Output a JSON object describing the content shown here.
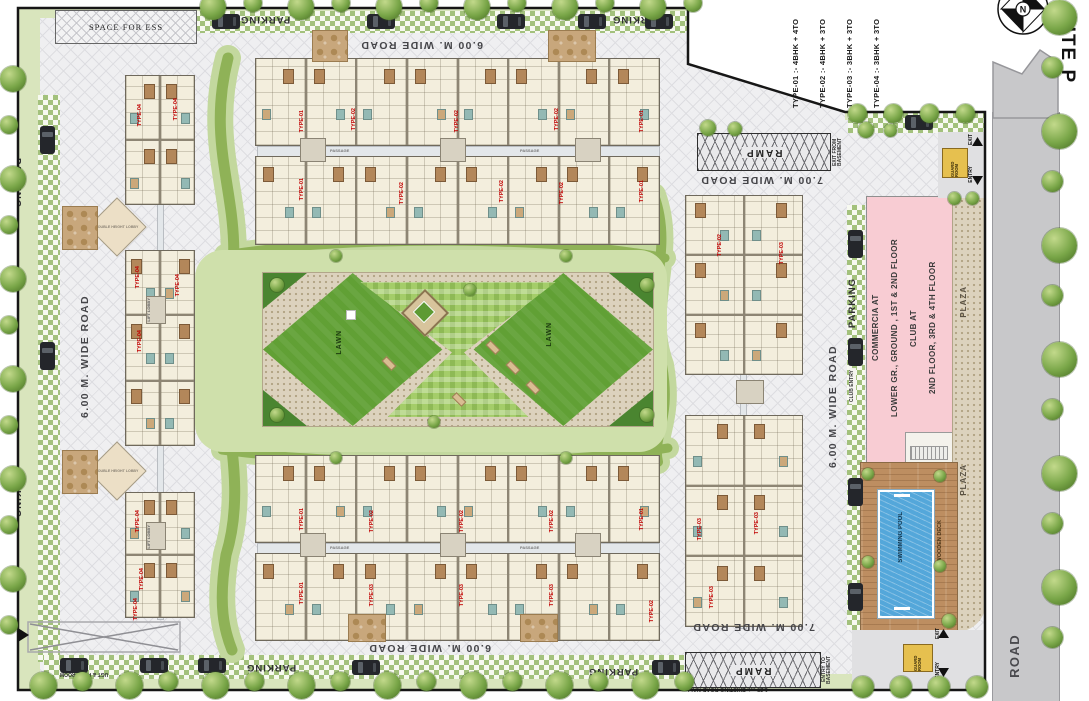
{
  "title": {
    "text": "SITE P",
    "north": "N"
  },
  "legend": {
    "items": [
      "TYPE-01 :- 4BHK + 4TO",
      "TYPE-02 :- 4BHK + 3TO",
      "TYPE-03 :- 3BHK + 3TO",
      "TYPE-04 :- 3BHK + 3TO"
    ]
  },
  "roads": {
    "wide6": "6.00 M. WIDE ROAD",
    "wide7": "7.00 M. WIDE ROAD",
    "main": "ROAD",
    "existing": "1.25 mt. EXISTING ROAD NALI"
  },
  "parking": {
    "label": "PARKING",
    "ugt": "UGT & PUMP ROOM"
  },
  "areas": {
    "space_for_ess": "SPACE FOR ESS",
    "lawn": "LAWN",
    "plaza": "PLAZA",
    "swimming_pool": "SWIMMING POOL",
    "wooden_deck": "WOODEN DECK",
    "club_entry": "CLUB ENTRY",
    "open_to_sky": "OPEN TO SKY",
    "passage": "PASSAGE",
    "lift_lobby": "LIFT LOBBY",
    "double_height_lobby": "DOUBLE HEIGHT LOBBY"
  },
  "access": {
    "ramp": "RAMP",
    "exit_from_basement": "EXIT FROM BASEMENT",
    "entry_to_basement": "ENTRY TO BASEMENT",
    "entry": "ENTRY",
    "exit": "EXIT",
    "guard_room": "GUARD ROOM"
  },
  "commercial": {
    "line1": "COMMERCIA AT",
    "line2": "LOWER GR., GROUND , 1ST & 2ND FLOOR",
    "line3": "CLUB AT",
    "line4": "2ND FLOOR, 3RD & 4TH FLOOR"
  },
  "unit_labels": [
    "TYPE-04",
    "TYPE-04",
    "TYPE-04",
    "TYPE-04",
    "TYPE-04",
    "TYPE-04",
    "TYPE-04",
    "TYPE-04",
    "TYPE-01",
    "TYPE-02",
    "TYPE-02",
    "TYPE-02",
    "TYPE-01",
    "TYPE-01",
    "TYPE-02",
    "TYPE-02",
    "TYPE-02",
    "TYPE-01",
    "TYPE-01",
    "TYPE-02",
    "TYPE-02",
    "TYPE-02",
    "TYPE-01",
    "TYPE-01",
    "TYPE-03",
    "TYPE-03",
    "TYPE-03",
    "TYPE-02",
    "TYPE-02",
    "TYPE-03",
    "TYPE-03",
    "TYPE-03",
    "TYPE-03"
  ],
  "colors": {
    "type_label": "#c00000",
    "commercial_block": "#f8ccd3",
    "pool": "#54a7da",
    "guard_room": "#e6c04f",
    "lawn": "#61a035"
  }
}
